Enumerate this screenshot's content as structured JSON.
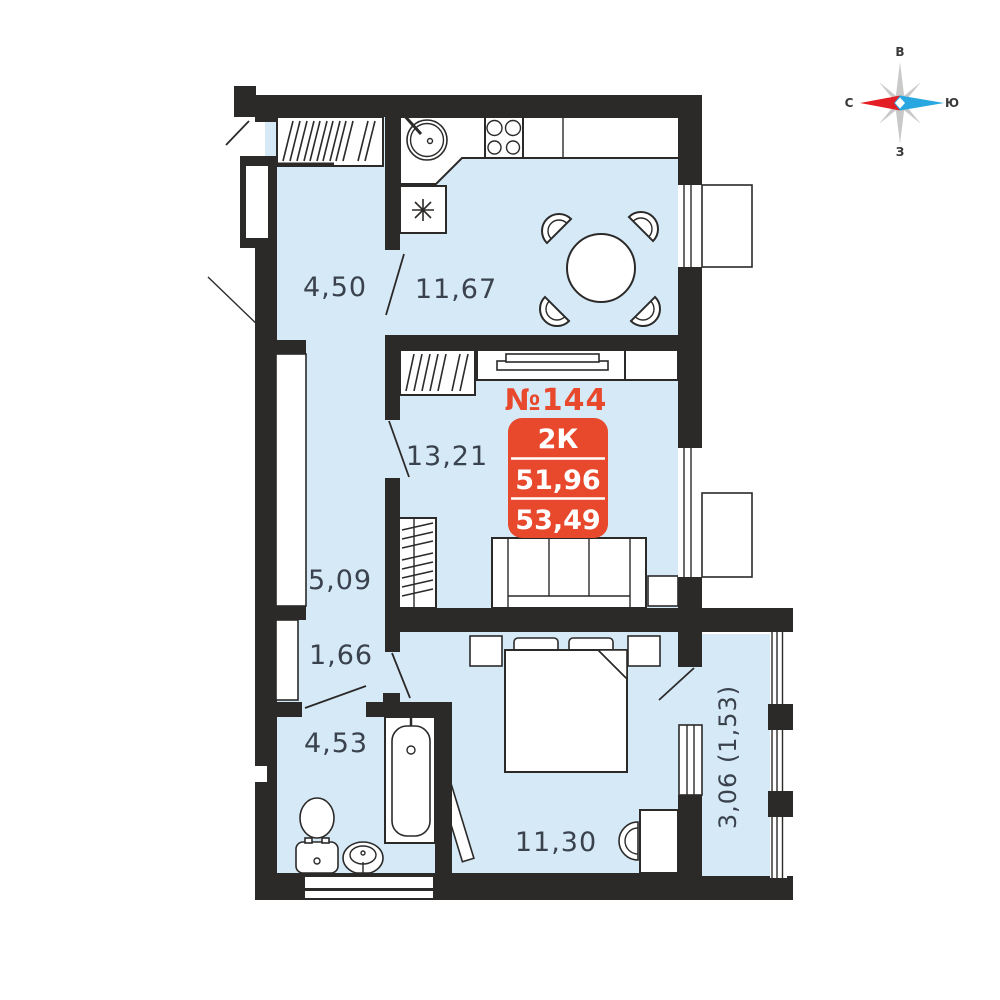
{
  "colors": {
    "room_fill": "#d6e9f7",
    "wall": "#2b2a29",
    "accent": "#e8482c",
    "label": "#3a424d",
    "compass_red": "#e31e24",
    "compass_blue": "#29a7e0",
    "compass_gray": "#c9c9c9"
  },
  "compass": {
    "top": "В",
    "left": "С",
    "right": "Ю",
    "bottom": "З"
  },
  "unit": {
    "number": "№144",
    "type": "2К",
    "area_living": "51,96",
    "area_total": "53,49"
  },
  "rooms": {
    "hallway": "4,50",
    "kitchen": "11,67",
    "living": "13,21",
    "corridor": "5,09",
    "vestibule": "1,66",
    "bathroom": "4,53",
    "bedroom": "11,30",
    "balcony": "3,06 (1,53)"
  }
}
